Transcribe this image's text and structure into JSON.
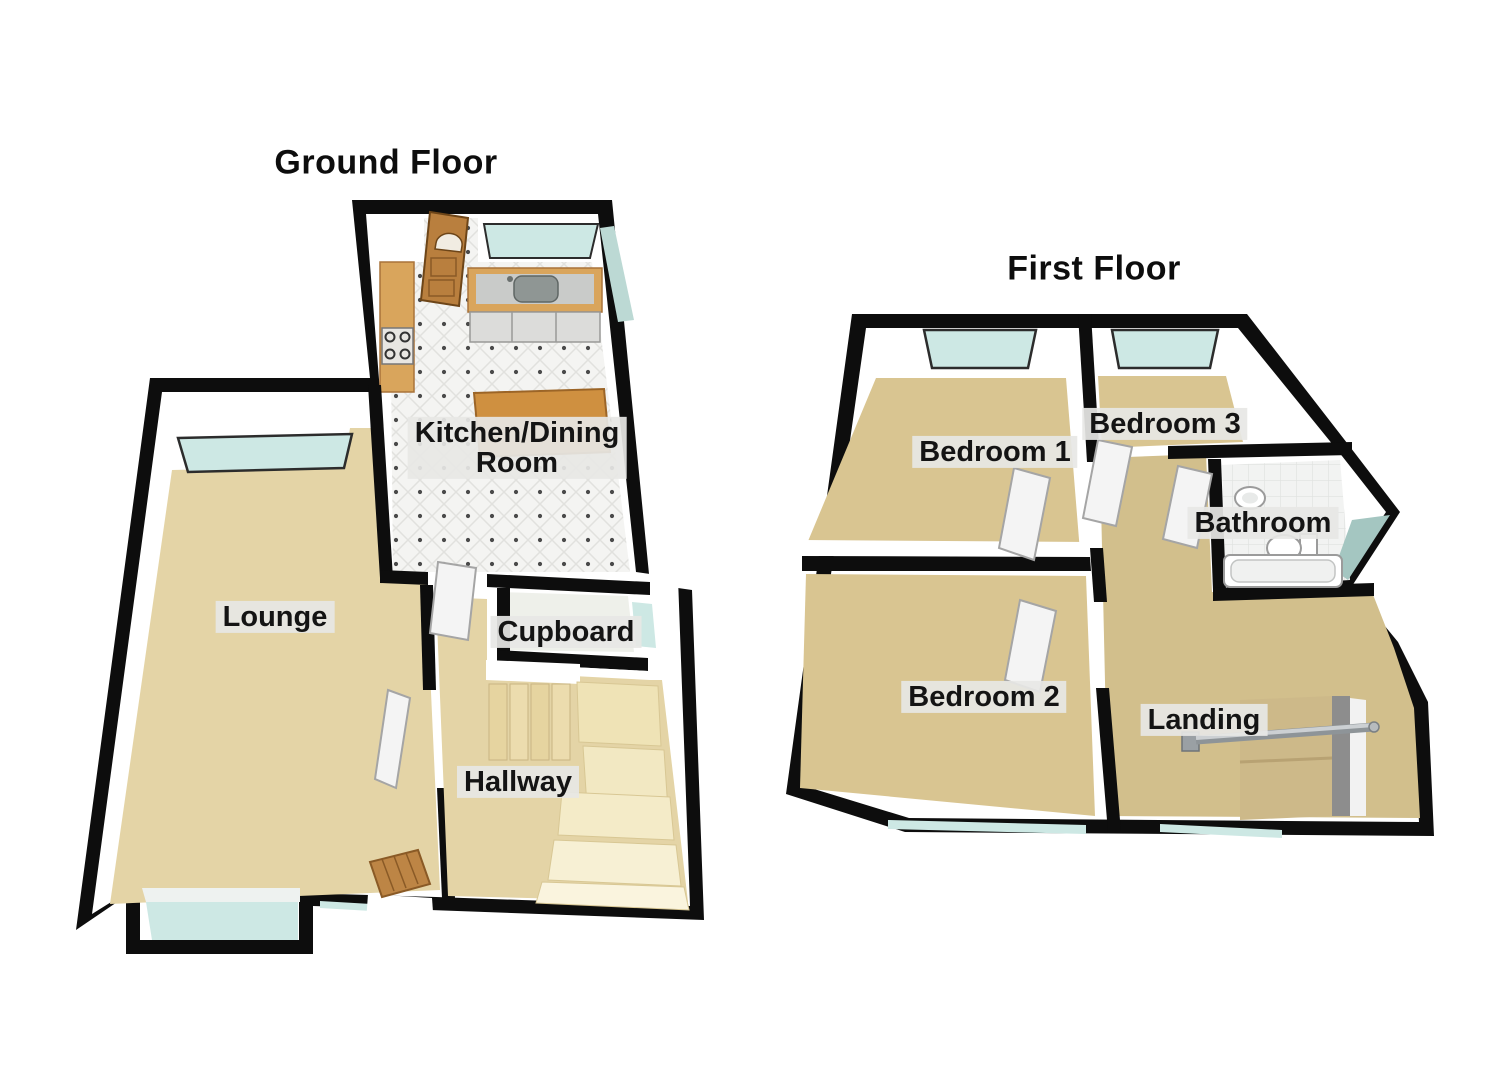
{
  "ground": {
    "title": "Ground Floor",
    "rooms": {
      "kitchen_line1": "Kitchen/Dining",
      "kitchen_line2": "Room",
      "lounge": "Lounge",
      "cupboard": "Cupboard",
      "hallway": "Hallway"
    }
  },
  "first": {
    "title": "First Floor",
    "rooms": {
      "bedroom1": "Bedroom 1",
      "bedroom3": "Bedroom 3",
      "bathroom": "Bathroom",
      "bedroom2": "Bedroom 2",
      "landing": "Landing"
    }
  },
  "colors": {
    "wall": "#0d0d0d",
    "inner_wall": "#ffffff",
    "carpet_ground": "#e4d4a6",
    "carpet_first": "#d9c591",
    "landing_carpet": "#d2bf8c",
    "stairwell": "#cdb989",
    "kitchen_tile": "#f4f4f2",
    "bath_tile": "#f2f3f2",
    "glass": "#cde8e4",
    "glass_dark": "#a4c6c1",
    "wood": "#c08040",
    "wood_light": "#d9a55c",
    "stair": "#ecdcae",
    "stair_light": "#f7f0d4",
    "door_white": "#f4f4f4",
    "chrome": "#bfc3c6",
    "label_bg": "#e7e7e5",
    "label_text": "#141414"
  }
}
